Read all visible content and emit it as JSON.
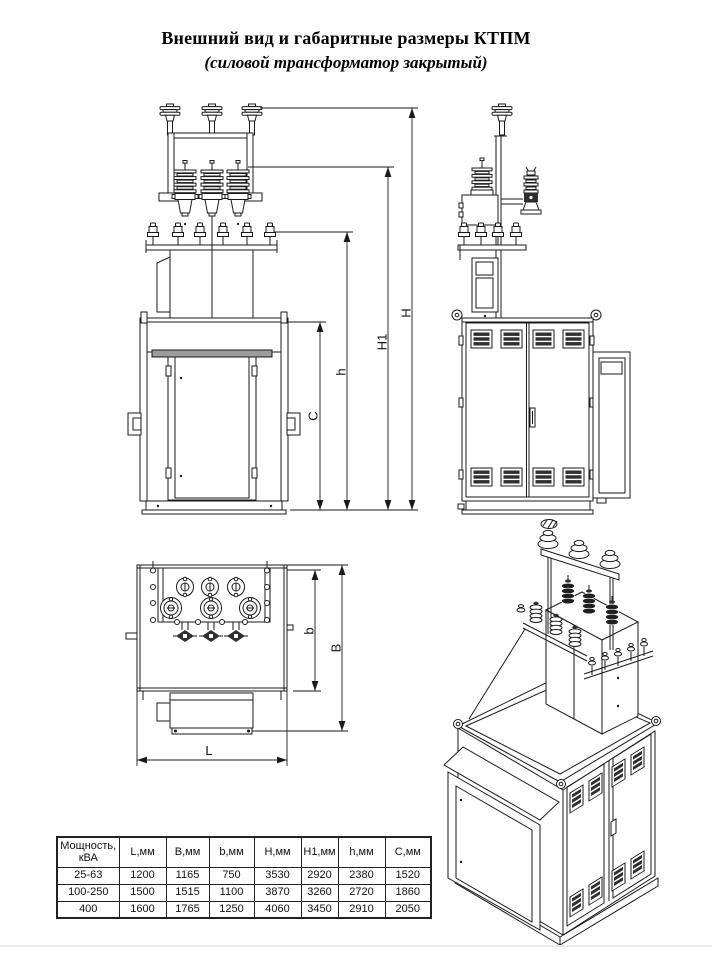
{
  "title": "Внешний вид и габаритные размеры КТПМ",
  "subtitle": "(силовой трансформатор закрытый)",
  "dims": {
    "C": "C",
    "h": "h",
    "H1": "H1",
    "H": "H",
    "L": "L",
    "b": "b",
    "B": "B"
  },
  "table": {
    "headers": [
      "Мощность, кВА",
      "L,мм",
      "B,мм",
      "b,мм",
      "Н,мм",
      "H1,мм",
      "h,мм",
      "С,мм"
    ],
    "rows": [
      [
        "25-63",
        "1200",
        "1165",
        "750",
        "3530",
        "2920",
        "2380",
        "1520"
      ],
      [
        "100-250",
        "1500",
        "1515",
        "1100",
        "3870",
        "3260",
        "2720",
        "1860"
      ],
      [
        "400",
        "1600",
        "1765",
        "1250",
        "4060",
        "3450",
        "2910",
        "2050"
      ]
    ]
  },
  "colors": {
    "line": "#1a1a1a",
    "louver": "#2f2f2f",
    "divider": "#e9e9e9",
    "paper": "#ffffff"
  }
}
